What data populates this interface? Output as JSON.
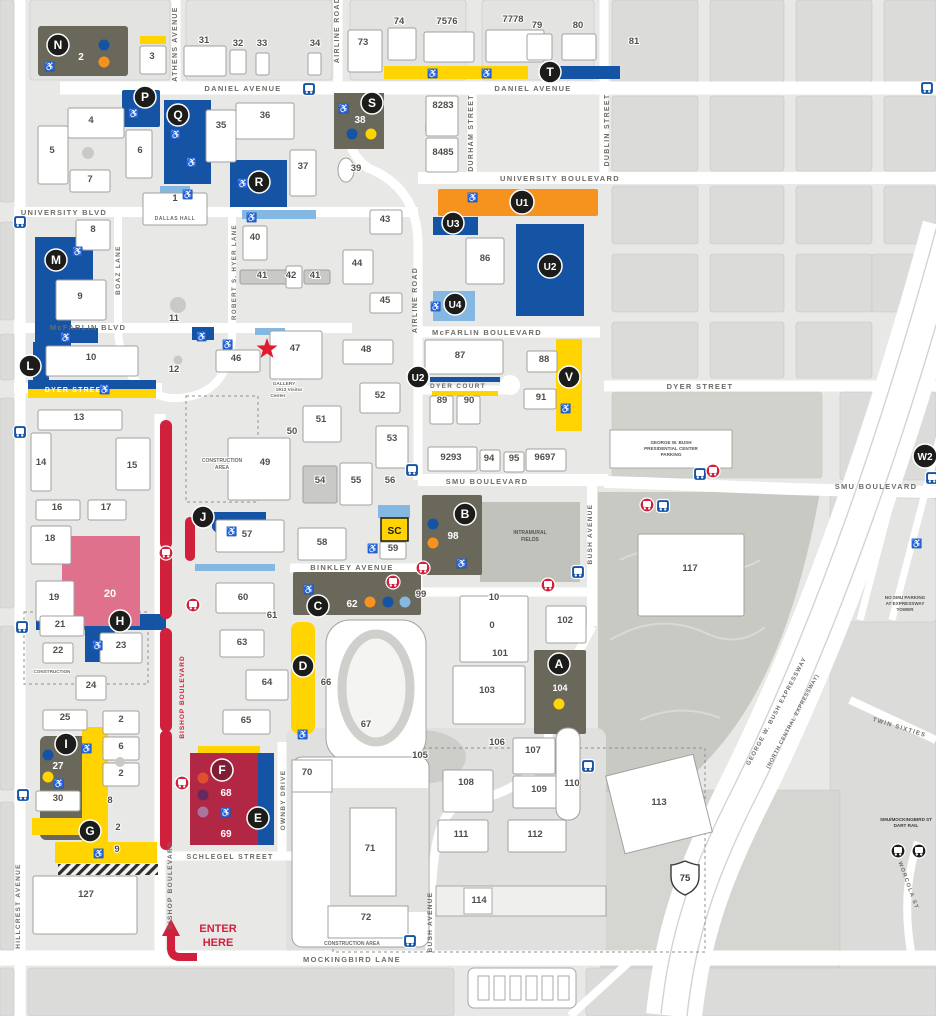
{
  "colors": {
    "blue": "#1553a4",
    "light_blue": "#85b7e3",
    "orange": "#f6921e",
    "yellow": "#ffd400",
    "olive": "#6a675b",
    "pink": "#e0718d",
    "crimson": "#b22744",
    "red": "#d0203c",
    "badge": "#1c1c1a",
    "f_badge": "#7e1d33",
    "dot_red": "#df4f2e",
    "dot_purple": "#66295f",
    "dot_lilac": "#a9749e",
    "field": "#c2c2bc",
    "park": "#c9c9c4"
  },
  "icons": {
    "accessible": "♿",
    "bus": "bus-front",
    "rail": "rail-station",
    "star": "visitor-center-star"
  },
  "streets": {
    "daniel": "DANIEL AVENUE",
    "athens": "ATHENS AVENUE",
    "airline": "AIRLINE ROAD",
    "durham": "DURHAM STREET",
    "dublin": "DUBLIN STREET",
    "university_blvd": "UNIVERSITY BLVD",
    "university_boulevard": "UNIVERSITY BOULEVARD",
    "boaz": "BOAZ LANE",
    "hyer": "ROBERT S. HYER LANE",
    "mcfarlin_blvd": "McFARLIN BLVD",
    "mcfarlin_boulevard": "McFARLIN BOULEVARD",
    "dyer_street": "DYER STREET",
    "dyer_court": "DYER COURT",
    "smu_boulevard": "SMU BOULEVARD",
    "bush_avenue": "BUSH AVENUE",
    "binkley": "BINKLEY AVENUE",
    "bishop": "BISHOP BOULEVARD",
    "ownby": "OWNBY DRIVE",
    "schlegel": "SCHLEGEL STREET",
    "mockingbird": "MOCKINGBIRD LANE",
    "hillcrest": "HILLCREST AVENUE",
    "gwb_expressway": "GEORGE W. BUSH EXPRESSWAY",
    "nc_expressway": "(NORTH CENTRAL EXPRESSWAY)",
    "twin_sixties": "TWIN SIXTIES",
    "worcola": "WORCOLA ST"
  },
  "lots": {
    "N": "N",
    "P": "P",
    "Q": "Q",
    "R": "R",
    "S": "S",
    "T": "T",
    "U1": "U1",
    "U2": "U2",
    "U3": "U3",
    "U4": "U4",
    "V": "V",
    "W2": "W2",
    "A": "A",
    "B": "B",
    "C": "C",
    "D": "D",
    "E": "E",
    "F": "F",
    "G": "G",
    "H": "H",
    "I": "I",
    "J": "J",
    "L": "L",
    "M": "M",
    "SC": "SC"
  },
  "lot_numbers": {
    "n2": "2",
    "s38": "38",
    "b98": "98",
    "c62": "62",
    "a104": "104",
    "i27": "27",
    "f68": "68",
    "f69": "69",
    "p20": "20"
  },
  "buildings": {
    "b1": "1",
    "b3": "3",
    "b4": "4",
    "b5": "5",
    "b6": "6",
    "b7": "7",
    "b8": "8",
    "b9": "9",
    "b10": "10",
    "b11": "11",
    "b12": "12",
    "b13": "13",
    "b14": "14",
    "b15": "15",
    "b16": "16",
    "b17": "17",
    "b18": "18",
    "b19": "19",
    "b21": "21",
    "b22": "22",
    "b23": "23",
    "b24": "24",
    "b25": "25",
    "b30": "30",
    "b31": "31",
    "b32": "32",
    "b33": "33",
    "b34": "34",
    "b35": "35",
    "b36": "36",
    "b37": "37",
    "b39": "39",
    "b40": "40",
    "b41a": "41",
    "b42": "42",
    "b41b": "41",
    "b43": "43",
    "b44": "44",
    "b45": "45",
    "b46": "46",
    "b47": "47",
    "b48": "48",
    "b49": "49",
    "b50": "50",
    "b51": "51",
    "b52": "52",
    "b53": "53",
    "b54": "54",
    "b55": "55",
    "b56": "56",
    "b57": "57",
    "b58": "58",
    "b59": "59",
    "b60": "60",
    "b61": "61",
    "b63": "63",
    "b64": "64",
    "b65": "65",
    "b66": "66",
    "b67": "67",
    "b70": "70",
    "b71": "71",
    "b72": "72",
    "b73": "73",
    "b74": "74",
    "b7576": "7576",
    "b7778": "7778",
    "b79": "79",
    "b80": "80",
    "b81": "81",
    "b8283": "8283",
    "b8485": "8485",
    "b86": "86",
    "b87": "87",
    "b88": "88",
    "b89": "89",
    "b90": "90",
    "b91": "91",
    "b9293": "9293",
    "b94": "94",
    "b95": "95",
    "b9697": "9697",
    "b99": "99",
    "b100_10": "10",
    "b100_0": "0",
    "b101": "101",
    "b102": "102",
    "b103": "103",
    "b105": "105",
    "b106": "106",
    "b107": "107",
    "b108": "108",
    "b109": "109",
    "b110": "110",
    "b111": "111",
    "b112": "112",
    "b113": "113",
    "b114": "114",
    "b117": "117",
    "b127": "127",
    "col2a": "2",
    "col6": "6",
    "col2b": "2",
    "g8": "8",
    "g2": "2",
    "g9": "9"
  },
  "labels": {
    "dallas_hall": "DALLAS HALL",
    "gallery1": "GALLERY",
    "gallery2": "1913   Visitor",
    "gallery3": "Center",
    "construction": "CONSTRUCTION",
    "construction_word": "CONSTRUCTION",
    "area_word": "AREA",
    "construction_area": "CONSTRUCTION AREA",
    "intramural1": "INTRAMURAL",
    "intramural2": "FIELDS",
    "bush1": "GEORGE W. BUSH",
    "bush2": "PRESIDENTIAL CENTER",
    "bush3": "PARKING",
    "nopark1": "NO SMU PARKING",
    "nopark2": "AT EXPRESSWAY",
    "nopark3": "TOWER",
    "dart1": "SMU/MOCKINGBIRD ST",
    "dart2": "DART RAIL",
    "enter1": "ENTER",
    "enter2": "HERE",
    "hwy": "75"
  }
}
